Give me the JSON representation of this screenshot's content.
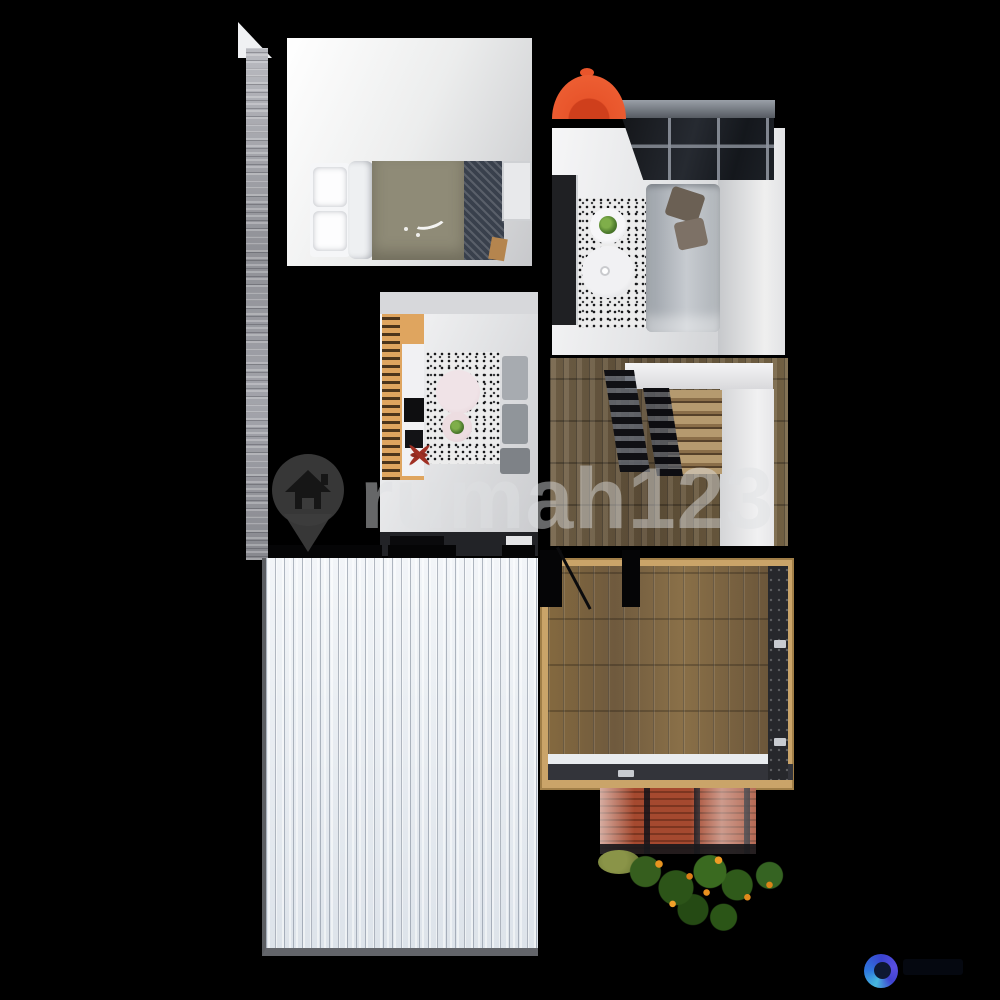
{
  "image": {
    "kind": "3d-floor-plan-top-view",
    "description": "Top-down 3D architectural render of an upper floor of a small two-storey house, on a black background (real-estate listing image)",
    "background_color": "#000000"
  },
  "watermark": {
    "brand_text": "rumah123",
    "icon": "house-pin-icon",
    "text_color": "rgba(222,224,226,0.46)",
    "pin_color": "#3d3d3d"
  },
  "partner_logo": {
    "icon": "blue-swirl-logo",
    "ring_colors": [
      "#5a4fe2",
      "#3a43cf",
      "#2e77dd",
      "#46b8de"
    ],
    "center_color": "#0e1833"
  },
  "scene": {
    "accent_colors": {
      "umbrella_orange": "#e8552b",
      "metal_roof_white": "#e9edf2",
      "deck_wood": "#7b6243",
      "tile_roof_terracotta": "#a5492f",
      "shrub_flower_orange": "#e8901f",
      "console_wood_orange": "#dfa55f"
    },
    "rooms": [
      {
        "name": "bedroom",
        "position": "top-left",
        "contents": [
          "double-bed",
          "white-pillows",
          "olive-duvet",
          "patterned-blanket",
          "nightstand"
        ]
      },
      {
        "name": "living-room",
        "position": "top-right",
        "contents": [
          "grey-sofa",
          "brown-cushions",
          "speckled-rug",
          "round-coffee-tables",
          "potted-plant",
          "tv-cabinet",
          "glass-canopy-skylight",
          "orange-umbrella"
        ]
      },
      {
        "name": "family-room",
        "position": "middle-left",
        "contents": [
          "slatted-wood-tv-console",
          "tv-screens",
          "speckled-rug",
          "round-side-tables",
          "red-plant",
          "grey-chairs",
          "kitchen-counter",
          "stove",
          "sink"
        ]
      },
      {
        "name": "stair-hall",
        "position": "middle-right",
        "contents": [
          "wood-floor",
          "wood-staircase",
          "dark-railings"
        ]
      },
      {
        "name": "metal-roof",
        "position": "bottom-left",
        "contents": [
          "white-corrugated-roof"
        ]
      },
      {
        "name": "roof-deck",
        "position": "bottom-right",
        "contents": [
          "wood-plank-deck",
          "dark-railing",
          "wood-frame"
        ]
      },
      {
        "name": "lower-tile-roof",
        "position": "below-deck",
        "contents": [
          "terracotta-tiles"
        ]
      },
      {
        "name": "garden",
        "position": "bottom",
        "contents": [
          "green-shrubs",
          "orange-flowers"
        ]
      }
    ]
  }
}
